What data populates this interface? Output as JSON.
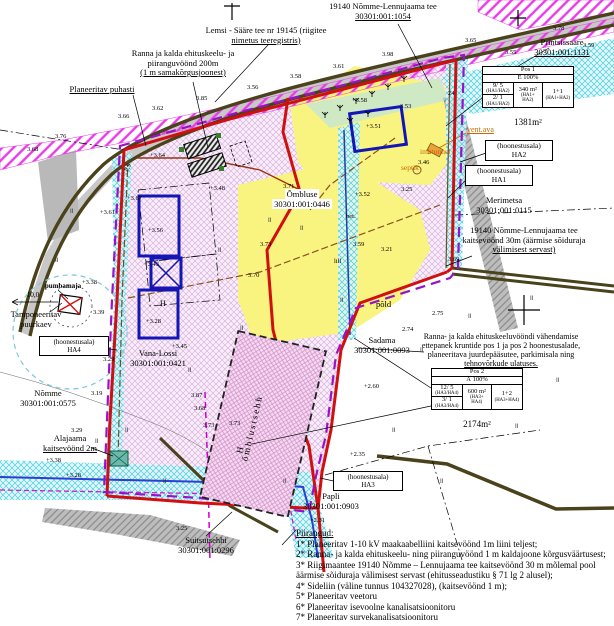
{
  "labels": {
    "road_top_1": "19140 Nõmme-Lennujaama tee",
    "road_top_2": "30301:001:1054",
    "lemsi_1": "Lemsi - Sääre tee nr 19145 (riigitee",
    "lemsi_2": "nimetus teeregistris)",
    "ranna200_1": "Ranna ja kalda ehituskeelu- ja",
    "ranna200_2": "piiranguvöönd 200m",
    "ranna200_3": "(1 m samakõrgusjoonest)",
    "puhasti": "Planeeritav puhasti",
    "printsissaare_1": "Printsissaare",
    "printsissaare_2": "30301:001:1131",
    "merimetsa_1": "Merimetsa",
    "merimetsa_2": "30301:001:0115",
    "kaitse30_1": "19140 Nõmme-Lennujaama tee",
    "kaitse30_2": "kaitsevöönd 30m (äärmise sõiduraja",
    "kaitse30_3": "välimisest servast)",
    "ombluse_1": "Õmbluse",
    "ombluse_2": "30301:001:0446",
    "pumbamaja": "pumbamaja",
    "dist10": "10,0",
    "tamponeeritav_1": "Tamponeeritav",
    "tamponeeritav_2": "puurkaev",
    "vana_lossi_1": "Vana-Lossi",
    "vana_lossi_2": "30301:001:0421",
    "nomme_1": "Nõmme",
    "nomme_2": "30301:001:0575",
    "sadama_1": "Sadama",
    "sadama_2": "30301:001:0093",
    "pold": "põld",
    "vahendamine_1": "Ranna- ja kalda ehituskeeluvööndi vähendamise",
    "vahendamine_2": "ettepanek kruntide pos 1 ja pos 2 hoonestusalade,",
    "vahendamine_3": "planeeritava juurdepääsutee, parkimisala ning",
    "vahendamine_4": "tehnovõrkude ulatuses.",
    "alajaam_1": "Alajaama",
    "alajaam_2": "kaitsevöönd 2m",
    "suitsutsehhi_1": "Suitsutsehhi",
    "suitsutsehhi_2": "30301:001:0296",
    "papli_1": "Papli",
    "papli_2": "30301:001:0903",
    "vent_ava": "vent.ava",
    "imbtunnel": "imbtunnel",
    "septik": "septik",
    "omblustsehh": "õmblustsehh",
    "measure89": "8,9",
    "bet": "bet.",
    "lill": "lill",
    "h1": "H",
    "h2": "H"
  },
  "hoonestusala": {
    "line1": "(hoonestusala)",
    "ha1": "HA1",
    "ha2": "HA2",
    "ha3": "HA3",
    "ha4": "HA4"
  },
  "pos1": {
    "title": "Pos 1",
    "pct": "E 100%",
    "k1": "9/ 5",
    "k1s": "(HA1/HA2)",
    "k2": "2/ 1",
    "k2s": "(HA1/HA2)",
    "m": "340 m²",
    "ms1": "(HA1+",
    "ms2": "HA2)",
    "c": "1+1",
    "cs": "(HA1+HA2)",
    "area": "1381m²"
  },
  "pos2": {
    "title": "Pos 2",
    "pct": "Ä 100%",
    "k1": "12/ 5",
    "k1s": "(HA3/HA4)",
    "k2": "3/ 1",
    "k2s": "(HA3/HA4)",
    "m": "600 m²",
    "ms1": "(HA3+",
    "ms2": "HA4)",
    "c": "1+2",
    "cs": "(HA3+HA4)",
    "area": "2174m²"
  },
  "piirangud": {
    "title": "Piirangud:",
    "items": [
      "1* Planeeritav 1-10 kV maakaabelliini kaitsevöönd 1m liini teljest;",
      "2* Ranna- ja kalda ehituskeelu- ning piiranguvöönd 1 m kaldajoone kõrgusväärtusest;",
      "3* Riigimaantee 19140 Nõmme – Lennujaama tee kaitsevöönd 30 m mõlemal pool\n      äärmise sõiduraja välimisest servast (ehitusseadustiku § 71 lg 2 alusel);",
      "4* Sideliin (väline tunnus 104327028), (kaitsevöönd 1 m);",
      "5* Planeeritav veetoru",
      "6* Planeeritav isevoolne kanalisatsioonitoru",
      "7* Planeeritav survekanalisatsioonitoru"
    ]
  },
  "spot_elevations": [
    {
      "x": 118,
      "y": 113,
      "v": "3.66"
    },
    {
      "x": 152,
      "y": 105,
      "v": "3.62"
    },
    {
      "x": 196,
      "y": 95,
      "v": "3.85"
    },
    {
      "x": 247,
      "y": 84,
      "v": "3.56"
    },
    {
      "x": 290,
      "y": 73,
      "v": "3.58"
    },
    {
      "x": 333,
      "y": 63,
      "v": "3.61"
    },
    {
      "x": 382,
      "y": 51,
      "v": "3.98"
    },
    {
      "x": 465,
      "y": 37,
      "v": "3.65"
    },
    {
      "x": 553,
      "y": 25,
      "v": "3.78"
    },
    {
      "x": 583,
      "y": 42,
      "v": "3.59"
    },
    {
      "x": 505,
      "y": 49,
      "v": "3.55"
    },
    {
      "x": 27,
      "y": 146,
      "v": "3.68"
    },
    {
      "x": 55,
      "y": 133,
      "v": "3.76"
    },
    {
      "x": 100,
      "y": 209,
      "v": "+3.61"
    },
    {
      "x": 127,
      "y": 195,
      "v": "+3.67"
    },
    {
      "x": 148,
      "y": 227,
      "v": "+3.56"
    },
    {
      "x": 144,
      "y": 261,
      "v": "+3.43"
    },
    {
      "x": 146,
      "y": 318,
      "v": "+3.28"
    },
    {
      "x": 210,
      "y": 185,
      "v": "+3.48"
    },
    {
      "x": 150,
      "y": 152,
      "v": "+3.64"
    },
    {
      "x": 352,
      "y": 97,
      "v": "+3.58"
    },
    {
      "x": 400,
      "y": 103,
      "v": "3.53"
    },
    {
      "x": 366,
      "y": 123,
      "v": "+3.51"
    },
    {
      "x": 418,
      "y": 159,
      "v": "3.46"
    },
    {
      "x": 401,
      "y": 186,
      "v": "3.25"
    },
    {
      "x": 355,
      "y": 191,
      "v": "+3.52"
    },
    {
      "x": 283,
      "y": 183,
      "v": "3.71"
    },
    {
      "x": 260,
      "y": 241,
      "v": "3.73"
    },
    {
      "x": 248,
      "y": 272,
      "v": "3.70"
    },
    {
      "x": 353,
      "y": 241,
      "v": "3.59"
    },
    {
      "x": 381,
      "y": 246,
      "v": "3.21"
    },
    {
      "x": 448,
      "y": 256,
      "v": "3.69"
    },
    {
      "x": 448,
      "y": 90,
      "v": "24"
    },
    {
      "x": 82,
      "y": 279,
      "v": "+3.38"
    },
    {
      "x": 93,
      "y": 309,
      "v": "3.39"
    },
    {
      "x": 172,
      "y": 343,
      "v": "+3.45"
    },
    {
      "x": 103,
      "y": 356,
      "v": "3.29"
    },
    {
      "x": 91,
      "y": 390,
      "v": "3.19"
    },
    {
      "x": 191,
      "y": 392,
      "v": "3.87"
    },
    {
      "x": 194,
      "y": 405,
      "v": "3.68"
    },
    {
      "x": 203,
      "y": 422,
      "v": "3.73"
    },
    {
      "x": 71,
      "y": 427,
      "v": "3.29"
    },
    {
      "x": 46,
      "y": 457,
      "v": "+3.38"
    },
    {
      "x": 66,
      "y": 472,
      "v": "+3.28"
    },
    {
      "x": 229,
      "y": 420,
      "v": "3.73"
    },
    {
      "x": 176,
      "y": 525,
      "v": "3.25"
    },
    {
      "x": 350,
      "y": 451,
      "v": "+2.35"
    },
    {
      "x": 310,
      "y": 517,
      "v": "+2.31"
    },
    {
      "x": 364,
      "y": 383,
      "v": "+2.60"
    },
    {
      "x": 402,
      "y": 326,
      "v": "2.74"
    },
    {
      "x": 432,
      "y": 310,
      "v": "2.75"
    }
  ],
  "colors": {
    "boundary_red": "#d01010",
    "plan_purple": "#9912c8",
    "magenta_hatch": "#e83ce8",
    "cyan_hatch": "#49cfe0",
    "yellow_zone": "#f9f37f",
    "lilac_zone": "#f7eef9",
    "road_olive": "#4a421a",
    "building_blue": "#1515b5",
    "utility_orange": "#c46a00"
  }
}
